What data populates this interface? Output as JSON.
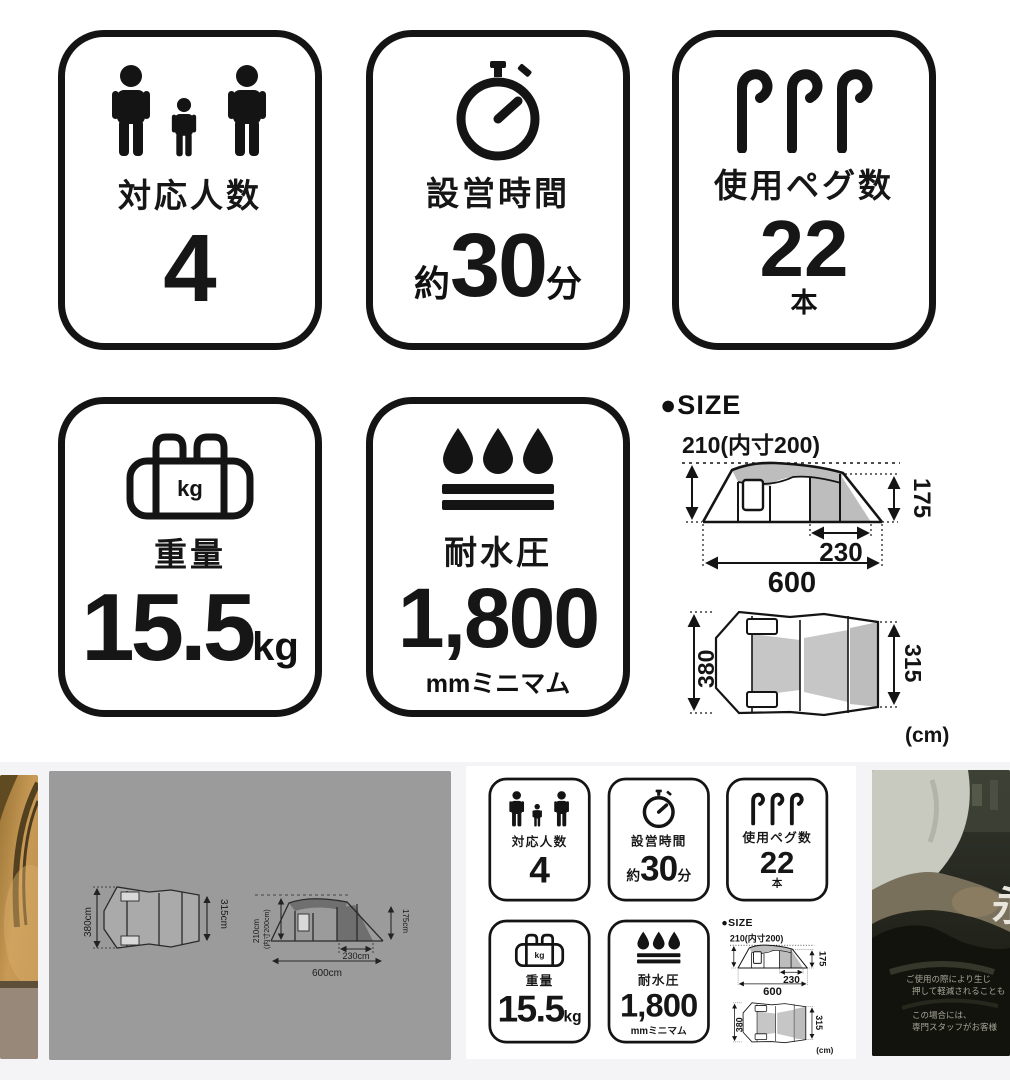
{
  "spec": {
    "badges": {
      "capacity": {
        "label": "対応人数",
        "value": "4"
      },
      "setup": {
        "label": "設営時間",
        "prefix": "約",
        "value": "30",
        "suffix": "分"
      },
      "pegs": {
        "label": "使用ペグ数",
        "value": "22",
        "unit": "本"
      },
      "weight": {
        "label": "重量",
        "value": "15.5",
        "unit": "kg",
        "icon_text": "kg"
      },
      "water": {
        "label": "耐水圧",
        "value": "1,800",
        "unit": "mmミニマム"
      }
    },
    "size": {
      "heading": "●SIZE",
      "side": {
        "top_label": "210(内寸200)",
        "right_label": "175",
        "inner_label": "230",
        "bottom_label": "600"
      },
      "plan": {
        "left_label": "380",
        "right_label": "315",
        "unit_label": "(cm)"
      }
    },
    "colors": {
      "line": "#141414",
      "shade": "#bdbdbd",
      "strip_bg": "#f4f4f6",
      "thumb_gray": "#9b9b9b"
    }
  },
  "thumbs": {
    "diagram": {
      "plan_left": "380cm",
      "plan_right": "315cm",
      "side_h1": "210cm",
      "side_h2": "(内寸200cm)",
      "side_right": "175cm",
      "side_inner": "230cm",
      "side_bottom": "600cm"
    },
    "photo": {
      "big_char": "永",
      "lines": [
        "ご使用の際により生じ",
        "押して軽減されることも",
        "この場合には、",
        "専門スタッフがお客様"
      ]
    }
  }
}
